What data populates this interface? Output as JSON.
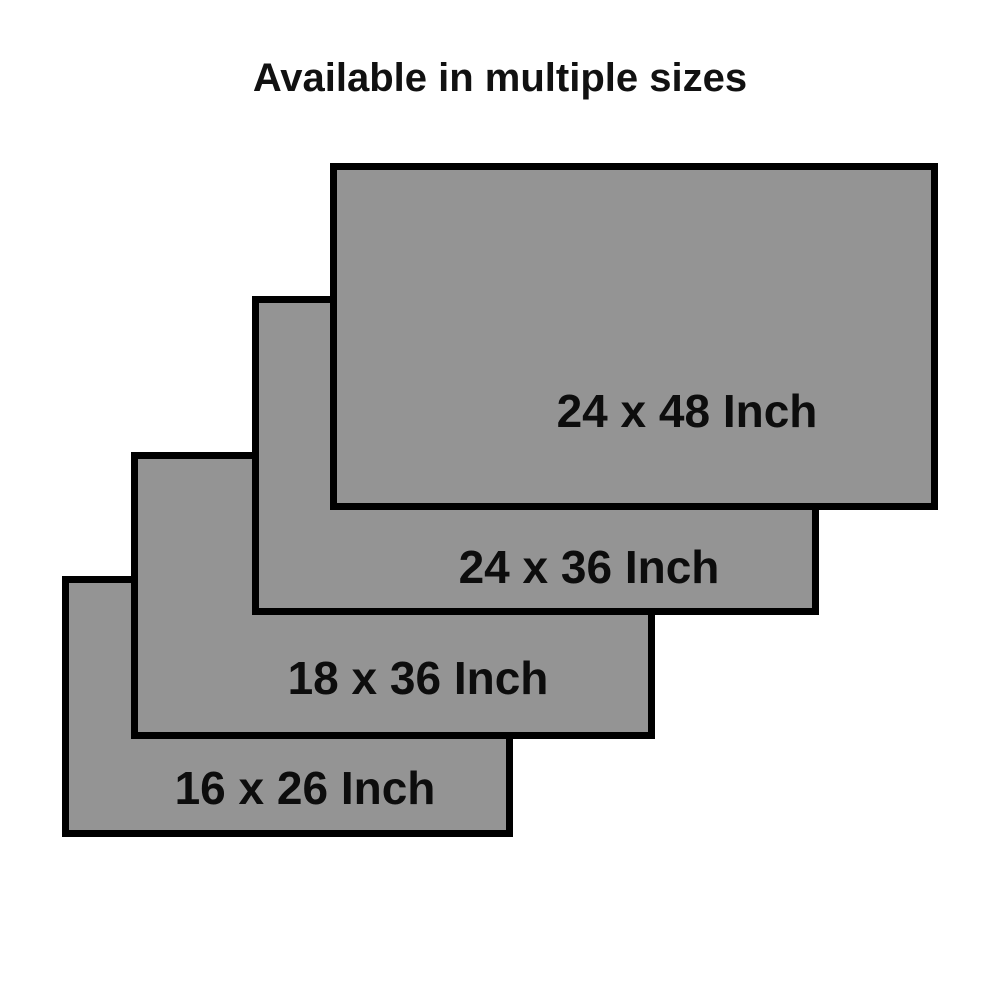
{
  "title": "Available in multiple sizes",
  "sizes": [
    {
      "label": "24 x 48 Inch",
      "width_in": 24,
      "height_in": 48
    },
    {
      "label": "24 x 36 Inch",
      "width_in": 24,
      "height_in": 36
    },
    {
      "label": "18 x 36 Inch",
      "width_in": 18,
      "height_in": 36
    },
    {
      "label": "16 x 26 Inch",
      "width_in": 16,
      "height_in": 26
    }
  ],
  "colors": {
    "background": "#ffffff",
    "panel_fill": "#949494",
    "panel_border": "#000000",
    "text": "#0d0d0d"
  }
}
